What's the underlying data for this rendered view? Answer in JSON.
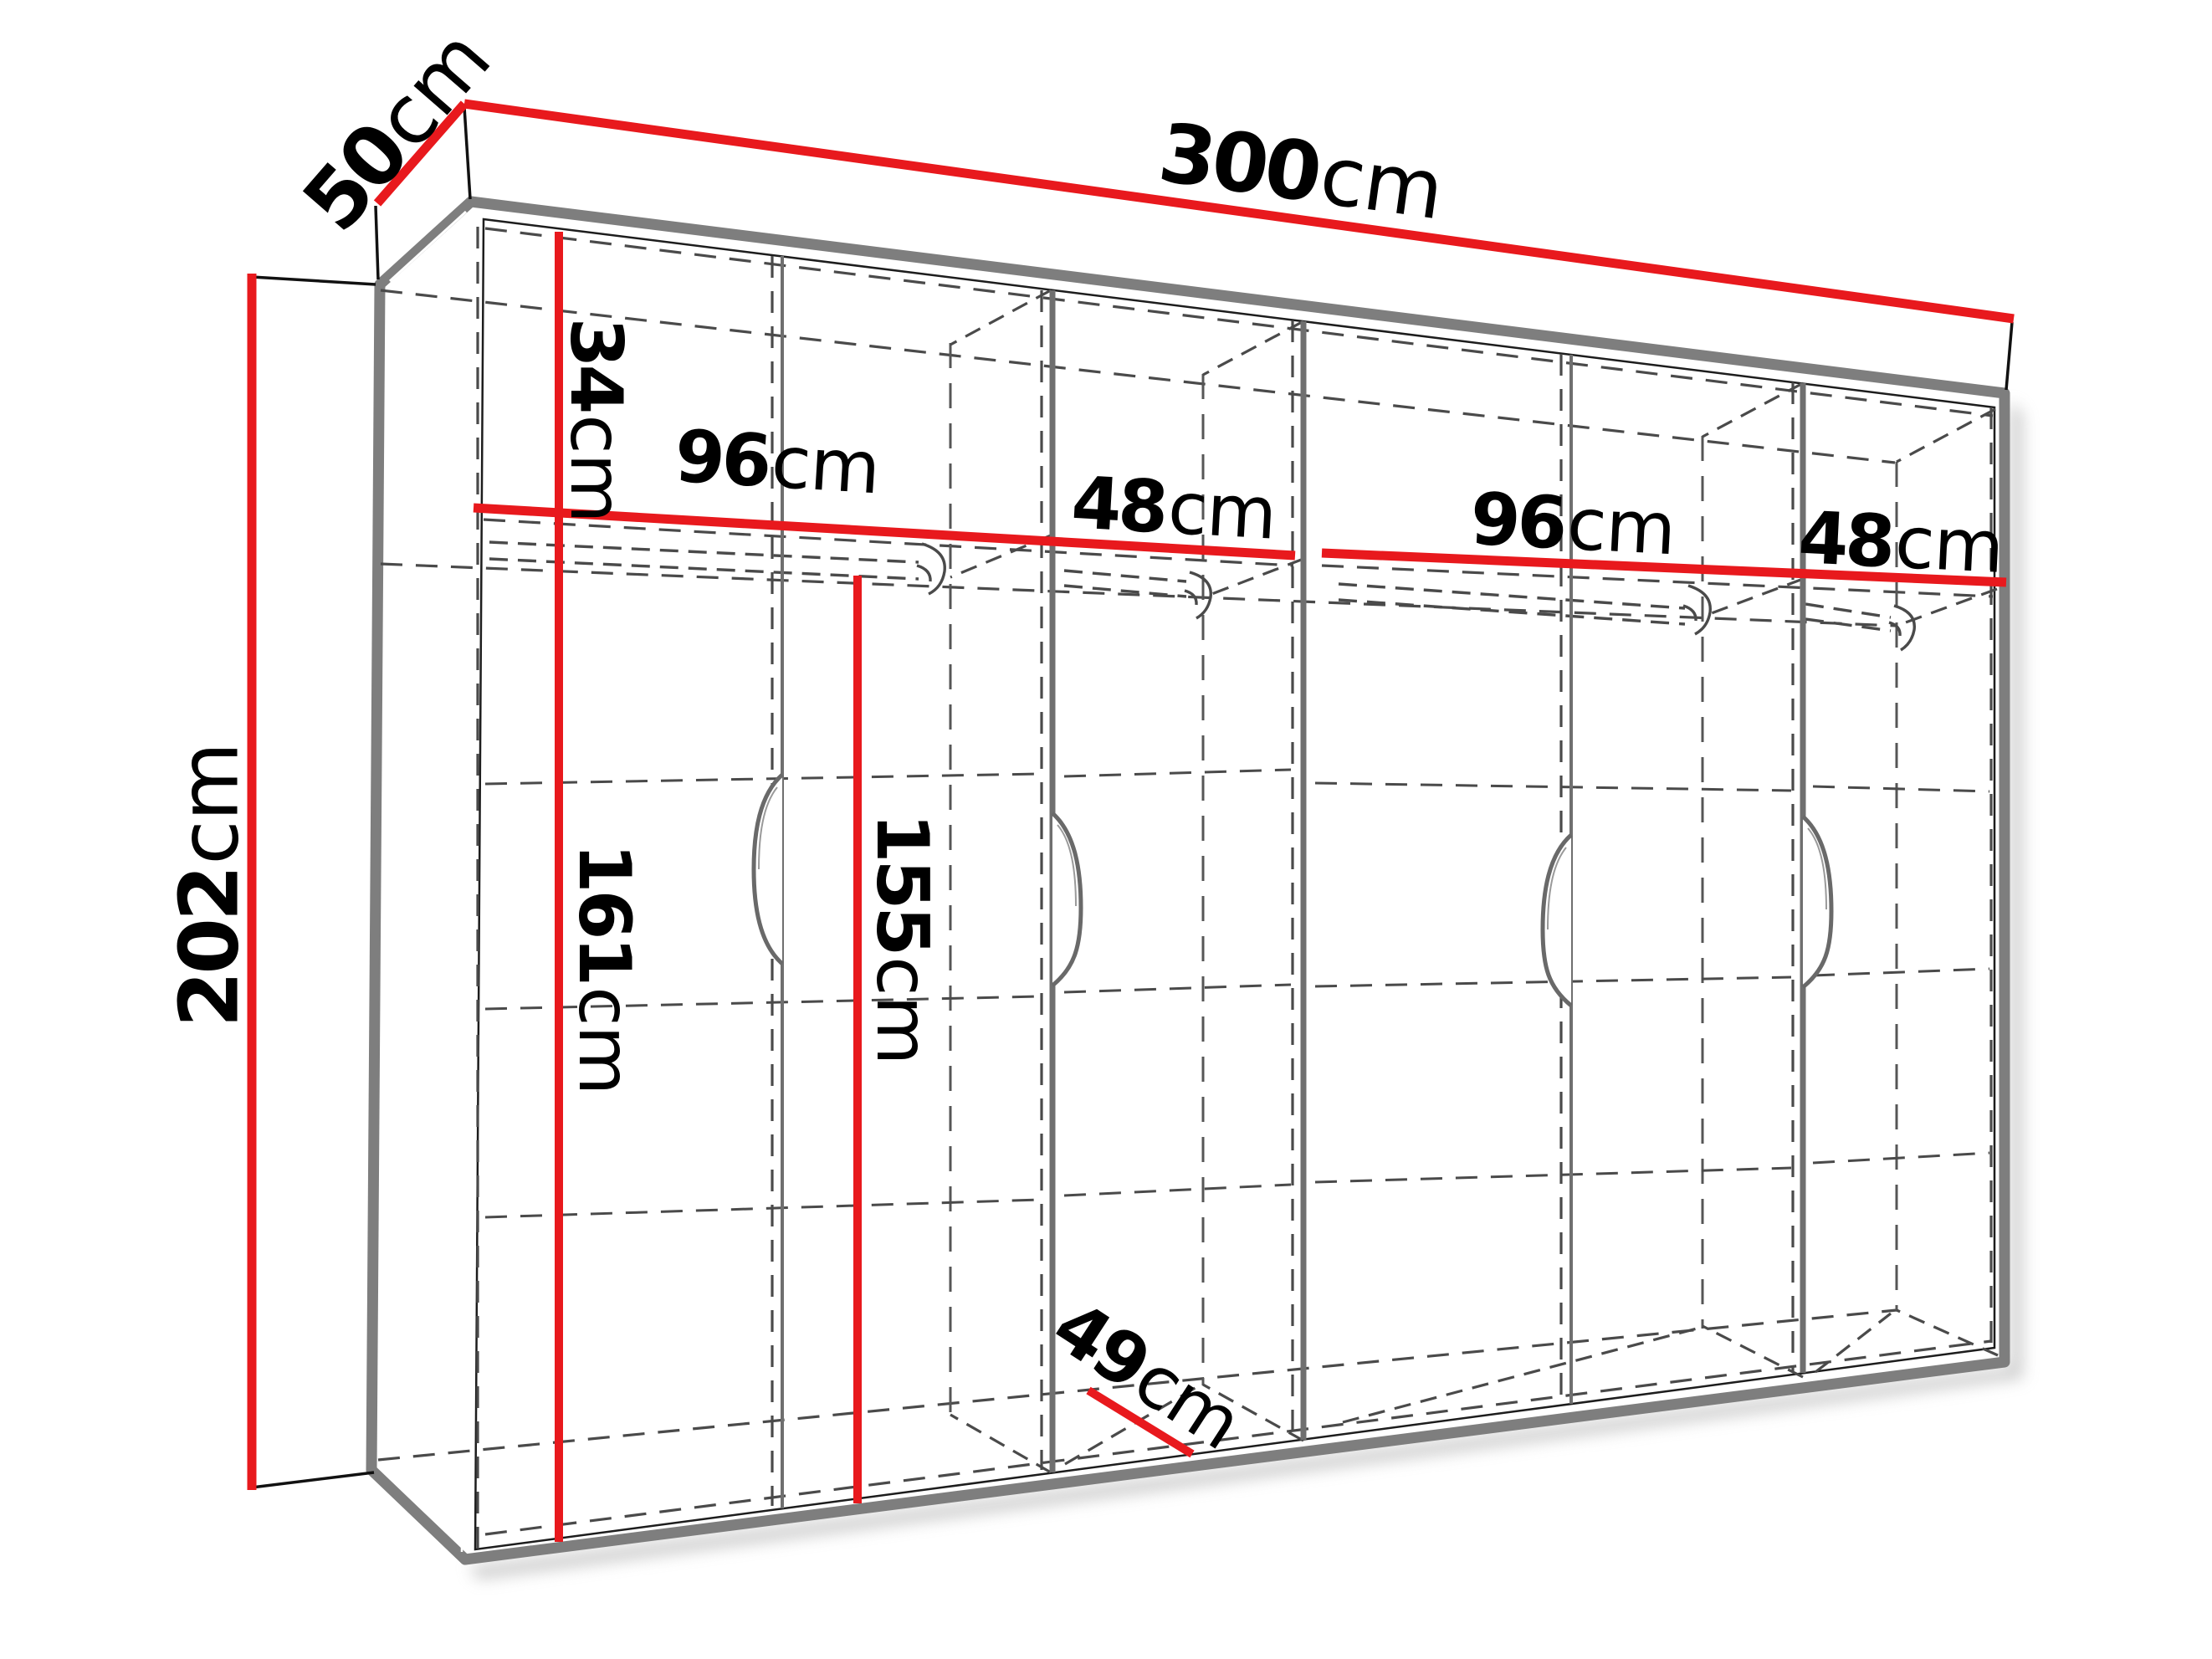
{
  "diagram": {
    "type": "wardrobe-dimension-drawing",
    "unit": "cm",
    "colors": {
      "dimension_red": "#e8191d",
      "outline_gray": "#7e7e7e",
      "dash_gray": "#4a4a4a",
      "extension_black": "#111111",
      "background": "#ffffff"
    }
  },
  "labels": {
    "width": {
      "num": "300",
      "unit": "cm"
    },
    "depth": {
      "num": "50",
      "unit": "cm"
    },
    "height": {
      "num": "202",
      "unit": "cm"
    },
    "top_shelf": {
      "num": "34",
      "unit": "cm"
    },
    "section1": {
      "num": "96",
      "unit": "cm"
    },
    "section2": {
      "num": "48",
      "unit": "cm"
    },
    "section3": {
      "num": "96",
      "unit": "cm"
    },
    "section4": {
      "num": "48",
      "unit": "cm"
    },
    "hang_left": {
      "num": "161",
      "unit": "cm"
    },
    "hang_mid": {
      "num": "155",
      "unit": "cm"
    },
    "depth_inner": {
      "num": "49",
      "unit": "cm"
    }
  }
}
